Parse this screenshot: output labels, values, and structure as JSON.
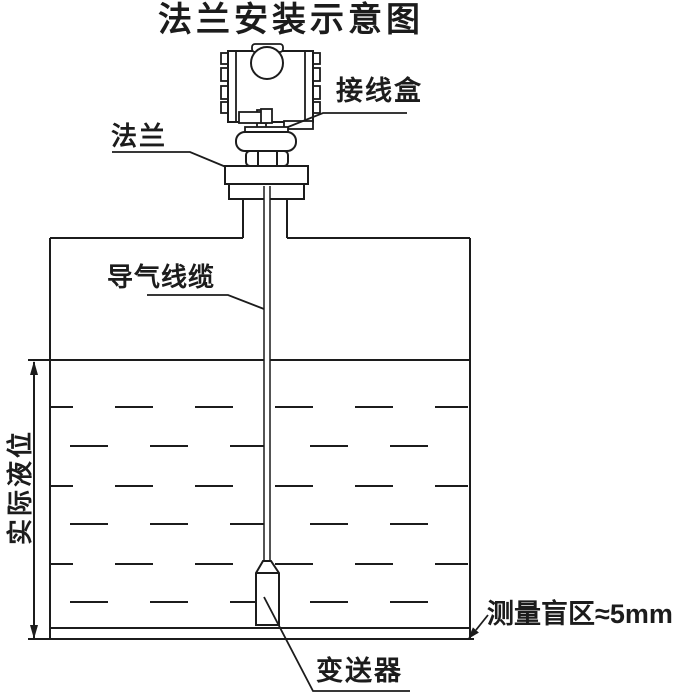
{
  "title": "法兰安装示意图",
  "labels": {
    "junction_box": "接线盒",
    "flange": "法兰",
    "air_cable": "导气线缆",
    "actual_level": "实际液位",
    "blind_zone": "测量盲区≈5mm",
    "transmitter": "变送器"
  },
  "diagram": {
    "type": "installation-schematic",
    "parts": [
      "transmitter-head",
      "junction-box",
      "swivel-coupling",
      "hex-nut",
      "flange-plate",
      "nozzle-neck",
      "tank",
      "liquid",
      "air-guide-cable",
      "sensor-weight"
    ],
    "dimension_note": "actual liquid level measured from liquid surface to tank bottom",
    "blind_zone_value": "≈5mm"
  },
  "colors": {
    "line": "#1c1c1c",
    "background": "#ffffff"
  }
}
